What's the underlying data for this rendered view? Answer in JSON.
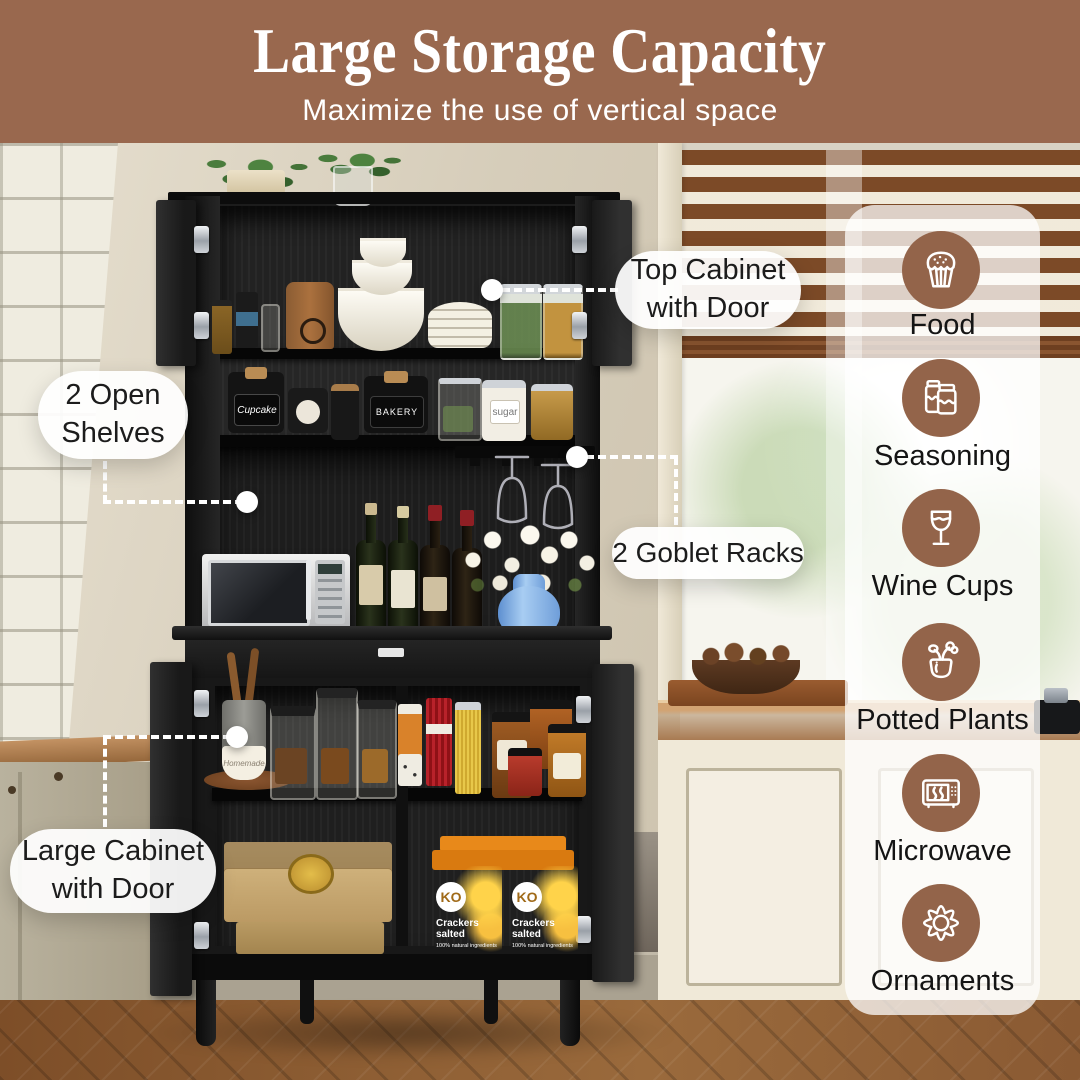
{
  "header": {
    "title": "Large Storage Capacity",
    "subtitle": "Maximize the use of vertical space"
  },
  "callouts": [
    {
      "id": "top-cabinet",
      "label": "Top Cabinet with Door"
    },
    {
      "id": "open-shelves",
      "label": "2 Open Shelves"
    },
    {
      "id": "goblet-racks",
      "label": "2 Goblet Racks"
    },
    {
      "id": "large-cabinet",
      "label": "Large Cabinet with Door"
    }
  ],
  "features": [
    {
      "icon": "cupcake-icon",
      "label": "Food"
    },
    {
      "icon": "seasoning-jars-icon",
      "label": "Seasoning"
    },
    {
      "icon": "wine-glass-icon",
      "label": "Wine Cups"
    },
    {
      "icon": "potted-plant-icon",
      "label": "Potted Plants"
    },
    {
      "icon": "microwave-icon",
      "label": "Microwave"
    },
    {
      "icon": "flower-icon",
      "label": "Ornaments"
    }
  ],
  "colors": {
    "header_bg": "#99684e",
    "icon_circle": "#93644a",
    "callout_text": "#1c1c1c",
    "leader_line": "#ffffff",
    "cabinet_black": "#181818"
  },
  "scene_text": {
    "jar_cupcake": "Cupcake",
    "jar_bakery": "BAKERY",
    "jar_sugar": "sugar",
    "bowl_homemade": "Homemade",
    "box_brand": "KO",
    "box_line1": "Crackers",
    "box_line2": "salted",
    "box_note": "100% natural ingredients"
  }
}
